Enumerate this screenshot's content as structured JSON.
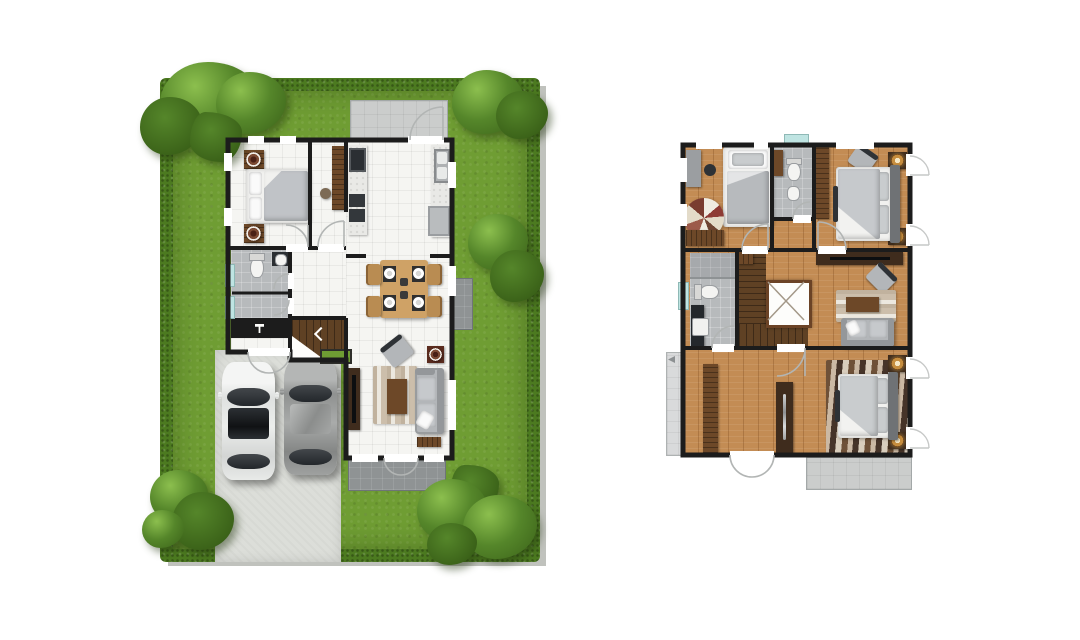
{
  "canvas": {
    "width": 1080,
    "height": 640,
    "background": "#ffffff"
  },
  "colors": {
    "background": "#ffffff",
    "grass": "#6f9d33",
    "hedge": "#4c7a20",
    "tree": "#55862a",
    "tree_hi": "#8cbf4e",
    "tree_dark": "#3a6118",
    "driveway": "#dcded9",
    "patio": "#cbcdcc",
    "terrace": "#8f9394",
    "wall": "#1c1c1c",
    "tile_white": "#f5f5f2",
    "gray_tile": "#b7babc",
    "wood": "#c38c54",
    "wood_dark": "#5f4124",
    "cabinet": "#6d4828",
    "cabinet_dark": "#3f2c1d",
    "marble": "#e9e9e6",
    "appliance": "#2b2f33",
    "sofa": "#b3b6b9",
    "sofa_dark": "#94979a",
    "cushion": "#c6c9cc",
    "bed_white": "#f1f1ef",
    "blanket": "#c0c3c7",
    "rug_beige": "#d9d0bf",
    "table_wood": "#cfa266",
    "chair_wood": "#b98c52",
    "teal": "#bfe4e2",
    "lamp": "#c68d3e",
    "glass": "#2e3236",
    "arc": "#b2b5b4",
    "void_frame": "#6b4326"
  },
  "left_plan": {
    "name": "first-floor-site-plan",
    "features": [
      "garden-lawn",
      "hedge-border",
      "corner-trees",
      "driveway",
      "parked-cars",
      "bedroom",
      "bathroom",
      "laundry-storage",
      "entry-porch",
      "kitchen",
      "rear-patio",
      "dining-area",
      "living-area",
      "staircase",
      "front-terrace",
      "ac-pad"
    ],
    "cars": [
      {
        "color": "white"
      },
      {
        "color": "silver-gray"
      }
    ],
    "dining_seats": 4,
    "bed_count": 1
  },
  "right_plan": {
    "name": "second-floor-plan",
    "features": [
      "bedroom-top-left",
      "bathroom-top",
      "master-bedroom",
      "hall-family-area",
      "bathroom-left",
      "staircase",
      "stair-void-open-below",
      "bedroom-bottom",
      "balcony-left",
      "balcony-bottom-right"
    ],
    "bed_count": 3,
    "bathroom_count": 2
  }
}
